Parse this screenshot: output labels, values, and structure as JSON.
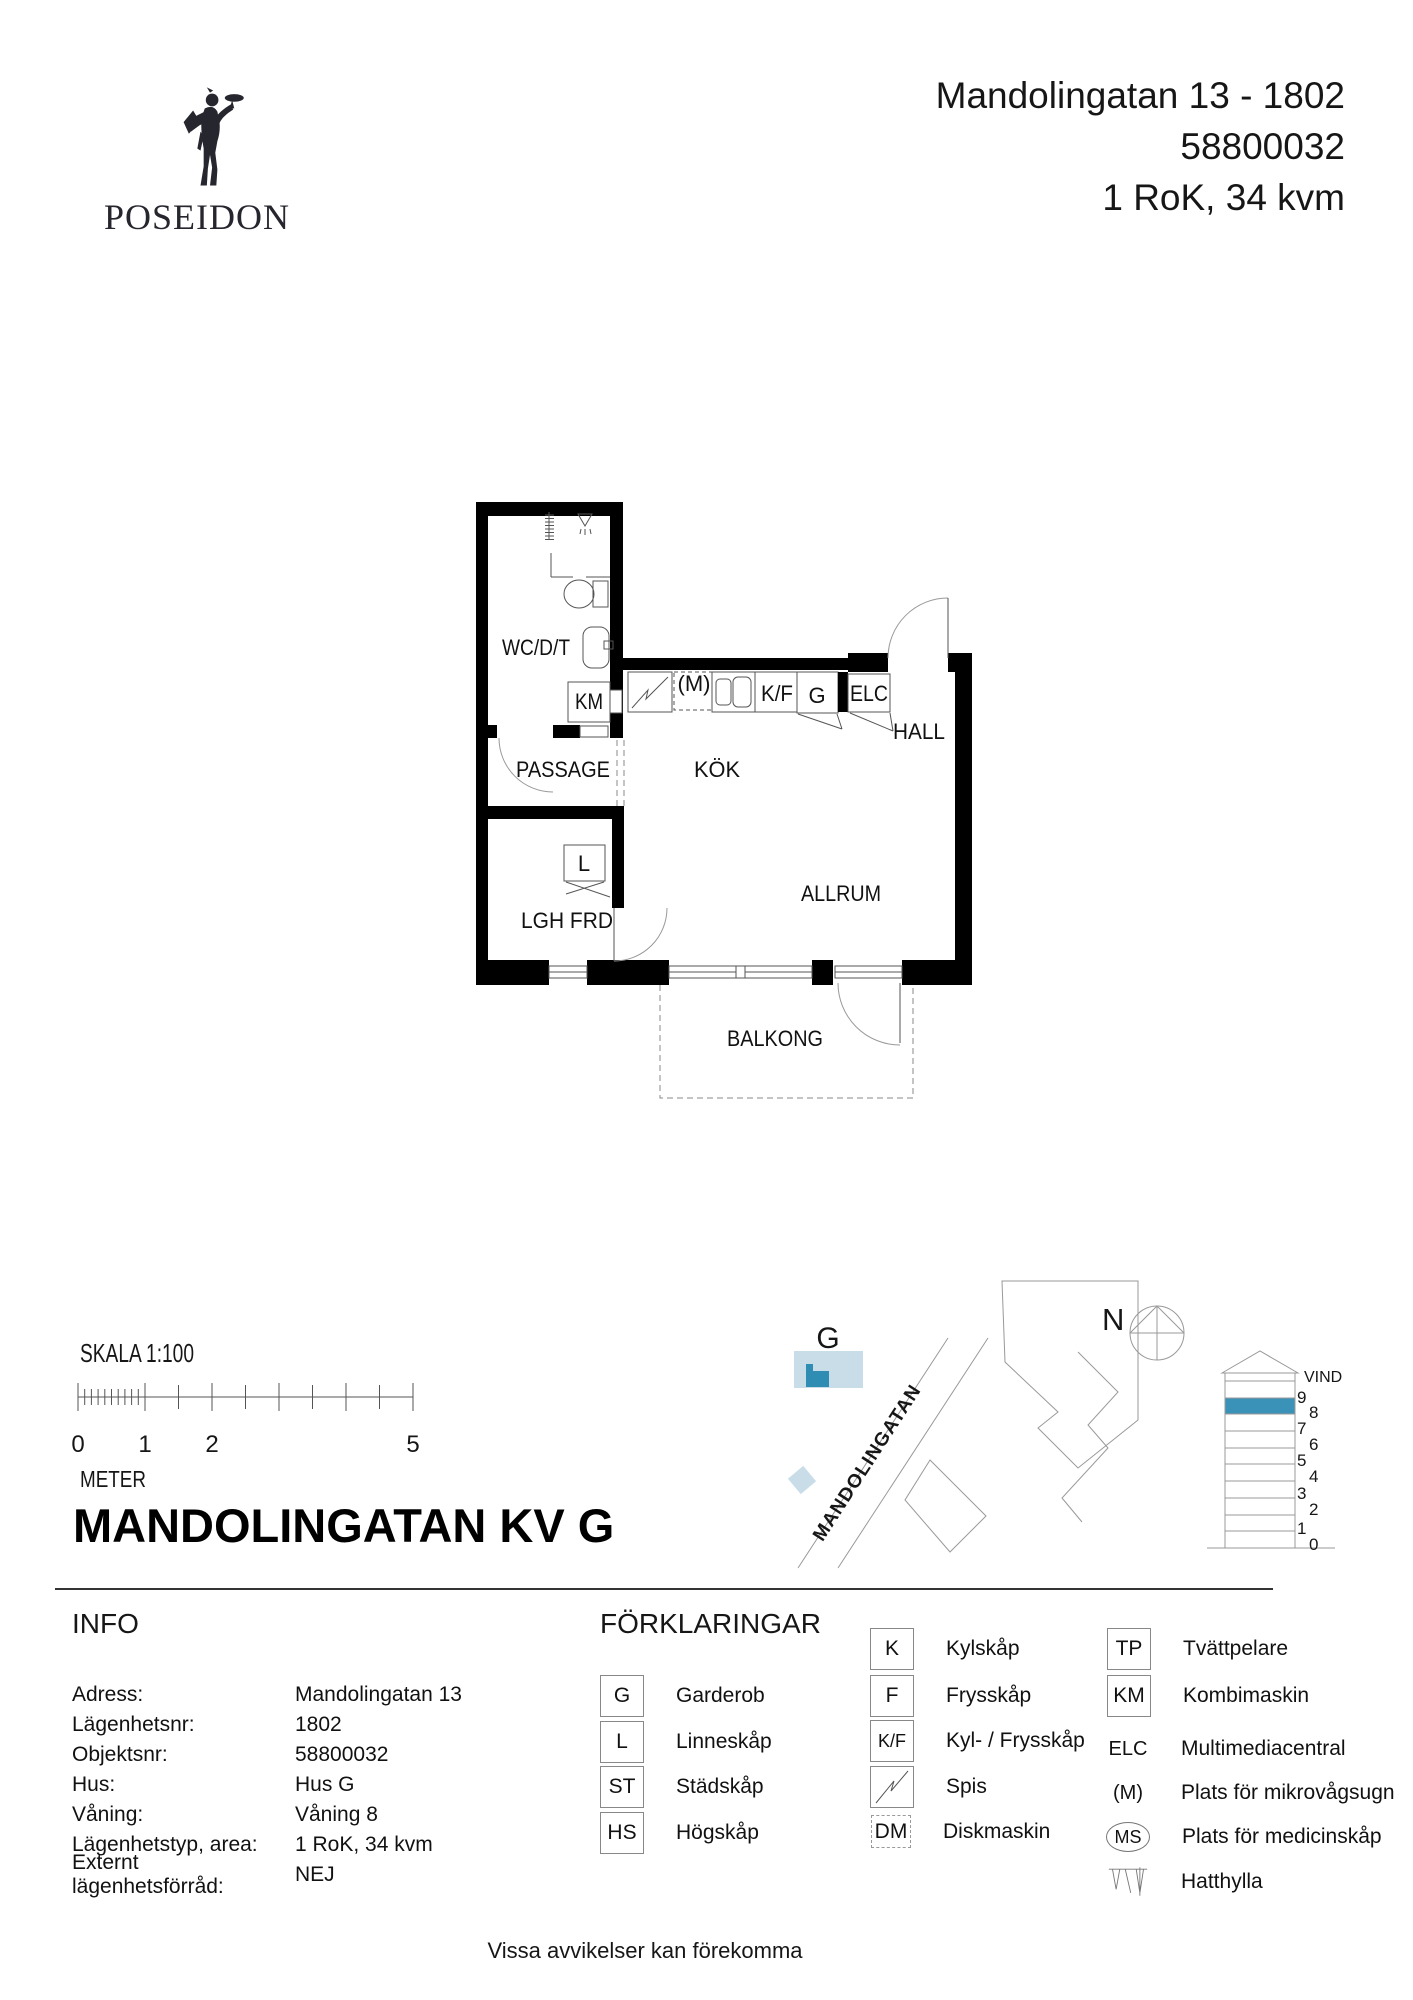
{
  "header": {
    "brand": "POSEIDON",
    "address_line": "Mandolingatan 13  - 1802",
    "object_number": "58800032",
    "apartment_type": "1 RoK, 34 kvm"
  },
  "plan": {
    "labels": {
      "wc": "WC/D/T",
      "km": "KM",
      "passage": "PASSAGE",
      "lghfrd": "LGH FRD",
      "l": "L",
      "kok": "KÖK",
      "m": "(M)",
      "kf": "K/F",
      "g": "G",
      "elc": "ELC",
      "hall": "HALL",
      "allrum": "ALLRUM",
      "balkong": "BALKONG"
    }
  },
  "scalebar": {
    "label": "SKALA 1:100",
    "numbers": [
      "0",
      "1",
      "2",
      "5"
    ],
    "unit": "METER"
  },
  "title": "MANDOLINGATAN KV G",
  "sitemap": {
    "building_label": "G",
    "street": "MANDOLINGATAN",
    "north": "N"
  },
  "elevation": {
    "attic": "VIND",
    "floors": [
      "9",
      "8",
      "7",
      "6",
      "5",
      "4",
      "3",
      "2",
      "1",
      "0"
    ],
    "highlight_color": "#3a92b8"
  },
  "info": {
    "heading": "INFO",
    "rows": [
      {
        "label": "Adress:",
        "value": "Mandolingatan 13"
      },
      {
        "label": "Lägenhetsnr:",
        "value": "1802"
      },
      {
        "label": "Objektsnr:",
        "value": "58800032"
      },
      {
        "label": "Hus:",
        "value": "Hus G"
      },
      {
        "label": "Våning:",
        "value": "Våning 8"
      },
      {
        "label": "Lägenhetstyp, area:",
        "value": "1 RoK, 34 kvm"
      },
      {
        "label": "Externt lägenhetsförråd:",
        "value": "NEJ"
      }
    ]
  },
  "legend": {
    "heading": "FÖRKLARINGAR",
    "col1": [
      {
        "sym": "G",
        "label": "Garderob"
      },
      {
        "sym": "L",
        "label": "Linneskåp"
      },
      {
        "sym": "ST",
        "label": "Städskåp"
      },
      {
        "sym": "HS",
        "label": "Högskåp"
      }
    ],
    "col2": [
      {
        "sym": "K",
        "label": "Kylskåp"
      },
      {
        "sym": "F",
        "label": "Frysskåp"
      },
      {
        "sym": "K/F",
        "label": "Kyl- / Frysskåp"
      },
      {
        "sym": "",
        "label": "Spis"
      },
      {
        "sym": "DM",
        "label": "Diskmaskin"
      }
    ],
    "col3": [
      {
        "sym": "TP",
        "label": "Tvättpelare"
      },
      {
        "sym": "KM",
        "label": "Kombimaskin"
      },
      {
        "sym": "ELC",
        "label": "Multimediacentral"
      },
      {
        "sym": "(M)",
        "label": "Plats för mikrovågsugn"
      },
      {
        "sym": "MS",
        "label": "Plats för medicinskåp"
      },
      {
        "sym": "",
        "label": "Hatthylla"
      }
    ]
  },
  "footer": "Vissa avvikelser kan förekomma",
  "colors": {
    "accent": "#3a92b8",
    "building_fill": "#c9dde9",
    "walls": "#000000"
  }
}
